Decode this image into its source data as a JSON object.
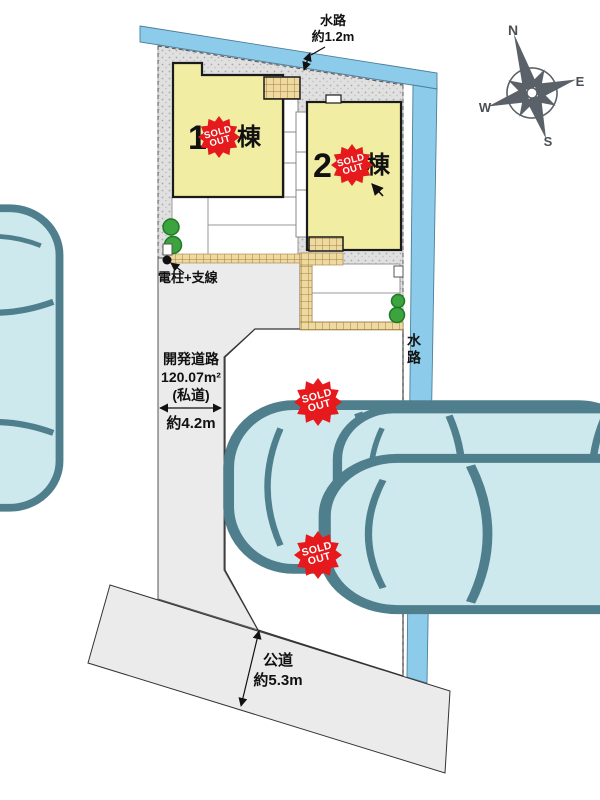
{
  "plan": {
    "waterway_top": {
      "name": "水路",
      "width": "約1.2m"
    },
    "waterway_right": {
      "name": "水路"
    },
    "utility_pole": {
      "label": "電柱+支線"
    },
    "development_road": {
      "name": "開発道路",
      "area": "120.07m²",
      "type": "(私道)",
      "width": "約4.2m"
    },
    "public_road": {
      "name": "公道",
      "width": "約5.3m"
    }
  },
  "badge": {
    "line1": "SOLD",
    "line2": "OUT"
  },
  "units": [
    {
      "number": "1",
      "suffix": "棟",
      "status": "sold out"
    },
    {
      "number": "2",
      "suffix": "棟",
      "status": "sold out"
    }
  ],
  "lots": [
    {
      "status": "sold out"
    },
    {
      "status": "sold out"
    }
  ],
  "compass": {
    "n": "N",
    "e": "E",
    "s": "S",
    "w": "W"
  },
  "colors": {
    "waterway": "#8ccbea",
    "building": "#f1eea3",
    "sold_out_red": "#e61a1c",
    "road": "#ebebeb",
    "ground": "#dfdfdf",
    "walkway": "#eeda9f",
    "car": "#cde9ee",
    "tree": "#3da33f",
    "compass": "#5b6168"
  }
}
